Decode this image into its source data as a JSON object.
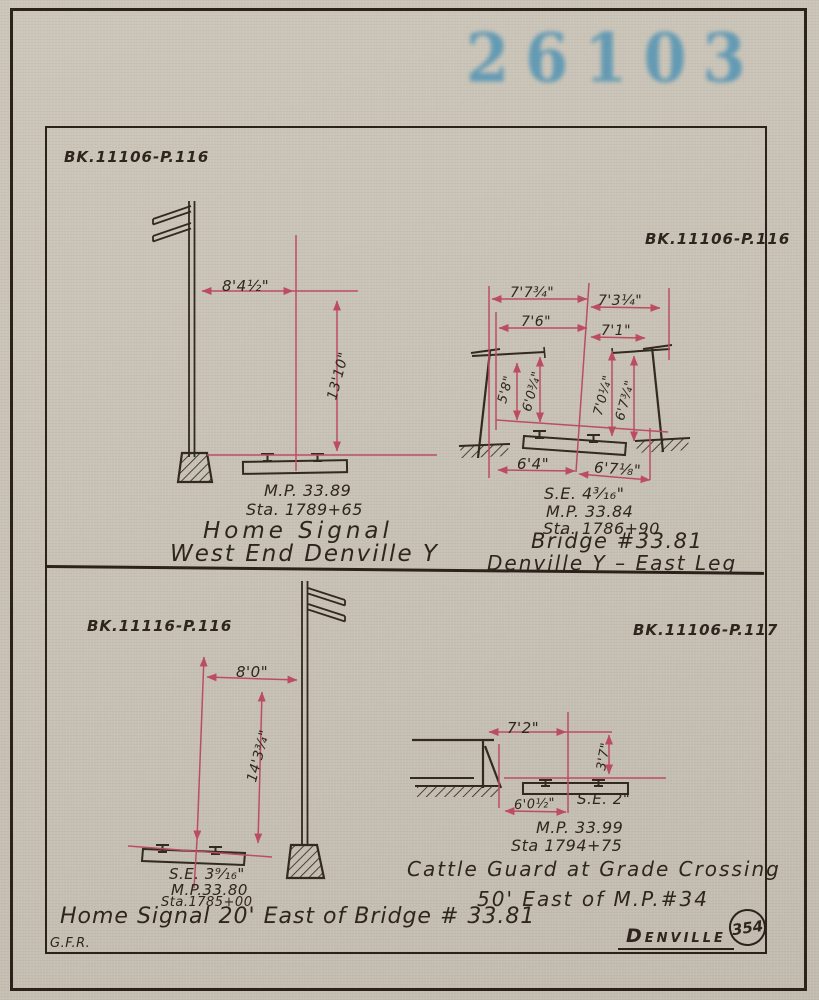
{
  "page": {
    "stamp": "26103",
    "footer": {
      "initials": "G.F.R.",
      "location": "Denville",
      "sheet_number": "354"
    }
  },
  "quadrants": {
    "home_signal_west": {
      "book_ref": "BK.11106-P.116",
      "dim_offset": "8'4½\"",
      "dim_height": "13'10\"",
      "milepost": "M.P. 33.89",
      "station": "Sta. 1789+65",
      "caption1": "Home Signal",
      "caption2": "West End Denville Y"
    },
    "bridge_east_leg": {
      "book_ref": "BK.11106-P.116",
      "dim_top_left": "7'7¾\"",
      "dim_top_right": "7'3¼\"",
      "dim_mid_left": "7'6\"",
      "dim_mid_right": "7'1\"",
      "dim_v1": "5'8\"",
      "dim_v2": "6'0¾\"",
      "dim_v3": "7'0¼\"",
      "dim_v4": "6'7¾\"",
      "dim_bottom_left": "6'4\"",
      "dim_bottom_right": "6'7⅛\"",
      "superelevation": "S.E. 4³⁄₁₆\"",
      "milepost": "M.P. 33.84",
      "station": "Sta. 1786+90",
      "caption1": "Bridge #33.81",
      "caption2": "Denville Y – East Leg"
    },
    "home_signal_east": {
      "book_ref": "BK.11116-P.116",
      "dim_offset": "8'0\"",
      "dim_height": "14'3¾\"",
      "superelevation": "S.E. 3⁹⁄₁₆\"",
      "milepost": "M.P.33.80",
      "station": "Sta.1785+00",
      "caption": "Home Signal 20' East of Bridge # 33.81"
    },
    "cattle_guard": {
      "book_ref": "BK.11106-P.117",
      "dim_top": "7'2\"",
      "dim_right": "3'7\"",
      "dim_bottom": "6'0½\"",
      "superelevation": "S.E. 2\"",
      "milepost": "M.P. 33.99",
      "station": "Sta 1794+75",
      "caption1": "Cattle Guard at Grade Crossing",
      "caption2": "50' East of M.P.#34"
    }
  }
}
